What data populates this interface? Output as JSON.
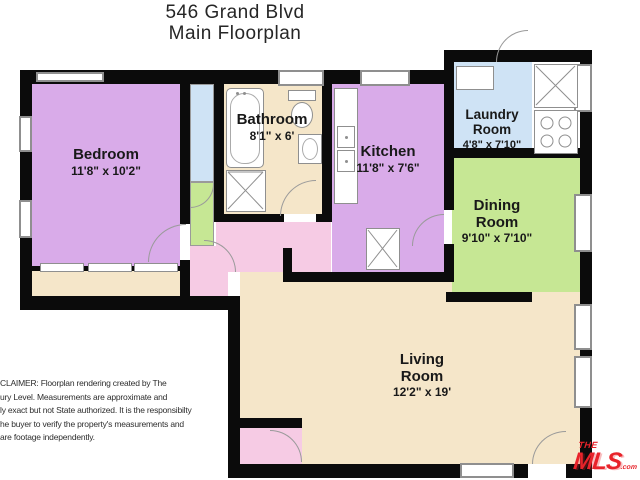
{
  "title": {
    "line1": "546 Grand Blvd",
    "line2": "Main Floorplan"
  },
  "rooms": [
    {
      "name": "Bedroom",
      "dims": "11'8\" x 10'2\"",
      "color": "#d9abe9"
    },
    {
      "name": "Bathroom",
      "dims": "8'1\" x 6'",
      "color": "#f5e6c9"
    },
    {
      "name": "Kitchen",
      "dims": "11'8\" x 7'6\"",
      "color": "#d9abe9"
    },
    {
      "name": "Laundry Room",
      "dims": "4'8\" x 7'10\"",
      "color": "#cfe3f5"
    },
    {
      "name": "Dining Room",
      "dims": "9'10\" x 7'10\"",
      "color": "#c6e794"
    },
    {
      "name": "Living Room",
      "dims": "12'2\" x 19'",
      "color": "#f5e6c9"
    }
  ],
  "fixtures": [
    "bathtub",
    "shower",
    "toilet",
    "bathroom-sink",
    "kitchen-counter",
    "kitchen-sink",
    "refrigerator",
    "laundry-counter",
    "water-heater",
    "stove",
    "closet-sliding-doors"
  ],
  "disclaimer": {
    "lines": [
      "CLAIMER: Floorplan rendering created by The",
      "ury Level.   Measurements are approximate and",
      "ly exact but not State authorized. It is the responsibilty",
      "he buyer to verify the property's measurements and",
      "are footage independently."
    ]
  },
  "logo": {
    "top": "THE",
    "main": "MLS",
    "suffix": ".com",
    "color": "#e8232a"
  },
  "colors": {
    "wall": "#0b0b0b",
    "hallway": "#f6cbe4",
    "outline": "#8f8f8f",
    "paper": "#ffffff"
  }
}
